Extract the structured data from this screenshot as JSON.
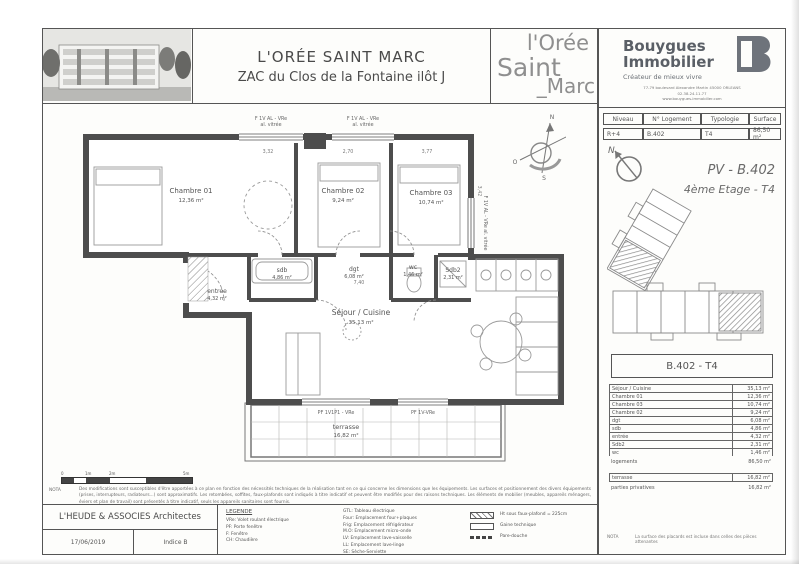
{
  "header": {
    "title": "L'ORÉE SAINT MARC",
    "subtitle": "ZAC du Clos de la Fontaine ilôt J",
    "logo": {
      "l1": "l'Orée",
      "l2": "Saint",
      "l3": "_Marc"
    }
  },
  "brand": {
    "name1": "Bouygues",
    "name2": "Immobilier",
    "tagline": "Créateur de mieux vivre",
    "address1": "77-79 boulevard Alexandre Martin 45000 ORLEANS",
    "address2": "02.38.24.11.77",
    "address3": "www.bouygues-immobilier.com"
  },
  "unit_table": {
    "col1": "Niveau",
    "col2": "N° Logement",
    "col3": "Typologie",
    "col4": "Surface",
    "val1": "R+4",
    "val2": "B.402",
    "val3": "T4",
    "val4": "86,50 m²"
  },
  "plan_header": {
    "ref": "PV - B.402",
    "floor": "4ème Etage - T4",
    "compass_n": "N"
  },
  "unit_box": {
    "title": "B.402 - T4"
  },
  "areas": {
    "rows": [
      {
        "label": "Séjour / Cuisine",
        "value": "35,13 m²"
      },
      {
        "label": "Chambre 01",
        "value": "12,36 m²"
      },
      {
        "label": "Chambre 03",
        "value": "10,74 m²"
      },
      {
        "label": "Chambre 02",
        "value": "9,24 m²"
      },
      {
        "label": "dgt",
        "value": "6,08 m²"
      },
      {
        "label": "sdb",
        "value": "4,86 m²"
      },
      {
        "label": "entrée",
        "value": "4,32 m²"
      },
      {
        "label": "Sdb2",
        "value": "2,31 m²"
      },
      {
        "label": "wc",
        "value": "1,46 m²"
      }
    ],
    "total_label": "logements",
    "total_value": "86,50 m²",
    "terrace_label": "terrasse",
    "terrace_value": "16,82 m²",
    "private_label": "parties privatives",
    "private_value": "16,82 m²",
    "nota_label": "NOTA",
    "nota_text": "La surface des placards est incluse dans celles des pièces attenantes"
  },
  "plan": {
    "rooms": {
      "ch1_name": "Chambre 01",
      "ch1_area": "12,36 m²",
      "ch2_name": "Chambre 02",
      "ch2_area": "9,24 m²",
      "ch3_name": "Chambre 03",
      "ch3_area": "10,74 m²",
      "sdb_name": "sdb",
      "sdb_area": "4,86 m²",
      "dgt_name": "dgt",
      "dgt_area": "6,08 m²",
      "sdb2_name": "Sdb2",
      "sdb2_area": "2,31 m²",
      "wc_name": "wc",
      "wc_area": "1,46 m²",
      "entree_name": "entrée",
      "entree_area": "4,32 m²",
      "sejour_name": "Séjour / Cuisine",
      "sejour_area": "35,13 m²",
      "terrasse_name": "terrasse",
      "terrasse_area": "16,82 m²"
    },
    "windows": {
      "w1a": "F 1V AL - VRe",
      "w1b": "al. vitrée",
      "w2a": "F 1V AL - VRe",
      "w2b": "al. vitrée",
      "w3": "F 1V AL - VRe  al. vitrée",
      "d1": "PF 1V1P1 - VRe",
      "d2": "PF 1V-VRe"
    },
    "dims": {
      "d1": "3,32",
      "d2": "2,70",
      "d3": "3,77",
      "d4": "3,42",
      "d5": "7,40"
    },
    "compass": {
      "n": "N",
      "s": "S",
      "e": "E",
      "o": "O"
    },
    "scale": {
      "t0": "0",
      "t1": "1m",
      "t2": "2m",
      "t3": "5m"
    }
  },
  "footer": {
    "nota_label": "NOTA",
    "nota_text": "Des modifications sont susceptibles d'être apportées à ce plan en fonction des nécessités techniques de la réalisation tant en ce qui concerne les dimensions que les équipements. Les surfaces et positionnement des divers équipements (prises, interrupteurs, radiateurs...) sont approximatifs. Les retombées, soffites, faux-plafonds sont indiqués à titre indicatif et peuvent être modifiés pour des raisons techniques. Les éléments de mobilier (meubles, appareils ménagers, éviers et plan de travail) sont présentés à titre indicatif, seuls les appareils sanitaires sont fournis.",
    "architect": "L'HEUDE & ASSOCIES Architectes",
    "date": "17/06/2019",
    "indice": "Indice  B",
    "legend_title": "LEGENDE",
    "legend_col1": [
      "VRe: Volet roulant électrique",
      "PF: Porte fenêtre",
      "F: Fenêtre",
      "CH: Chaudière"
    ],
    "legend_col2": [
      "GTL: Tableau électrique",
      "Four: Emplacement four+plaques",
      "Frig: Emplacement réfrigérateur",
      "M.O: Emplacement micro-onde",
      "LV: Emplacement lave-vaisselle",
      "LL: Emplacement lave-linge",
      "SE: Sèche-Serviette"
    ],
    "legend_sym1": "Ht sous faux-plafond = 225cm",
    "legend_sym2": "Gaine technique",
    "legend_sym3": "Pare-douche"
  },
  "colors": {
    "ink": "#4d4d4d",
    "light": "#9a9a9a",
    "brand_gray": "#6e737b"
  }
}
